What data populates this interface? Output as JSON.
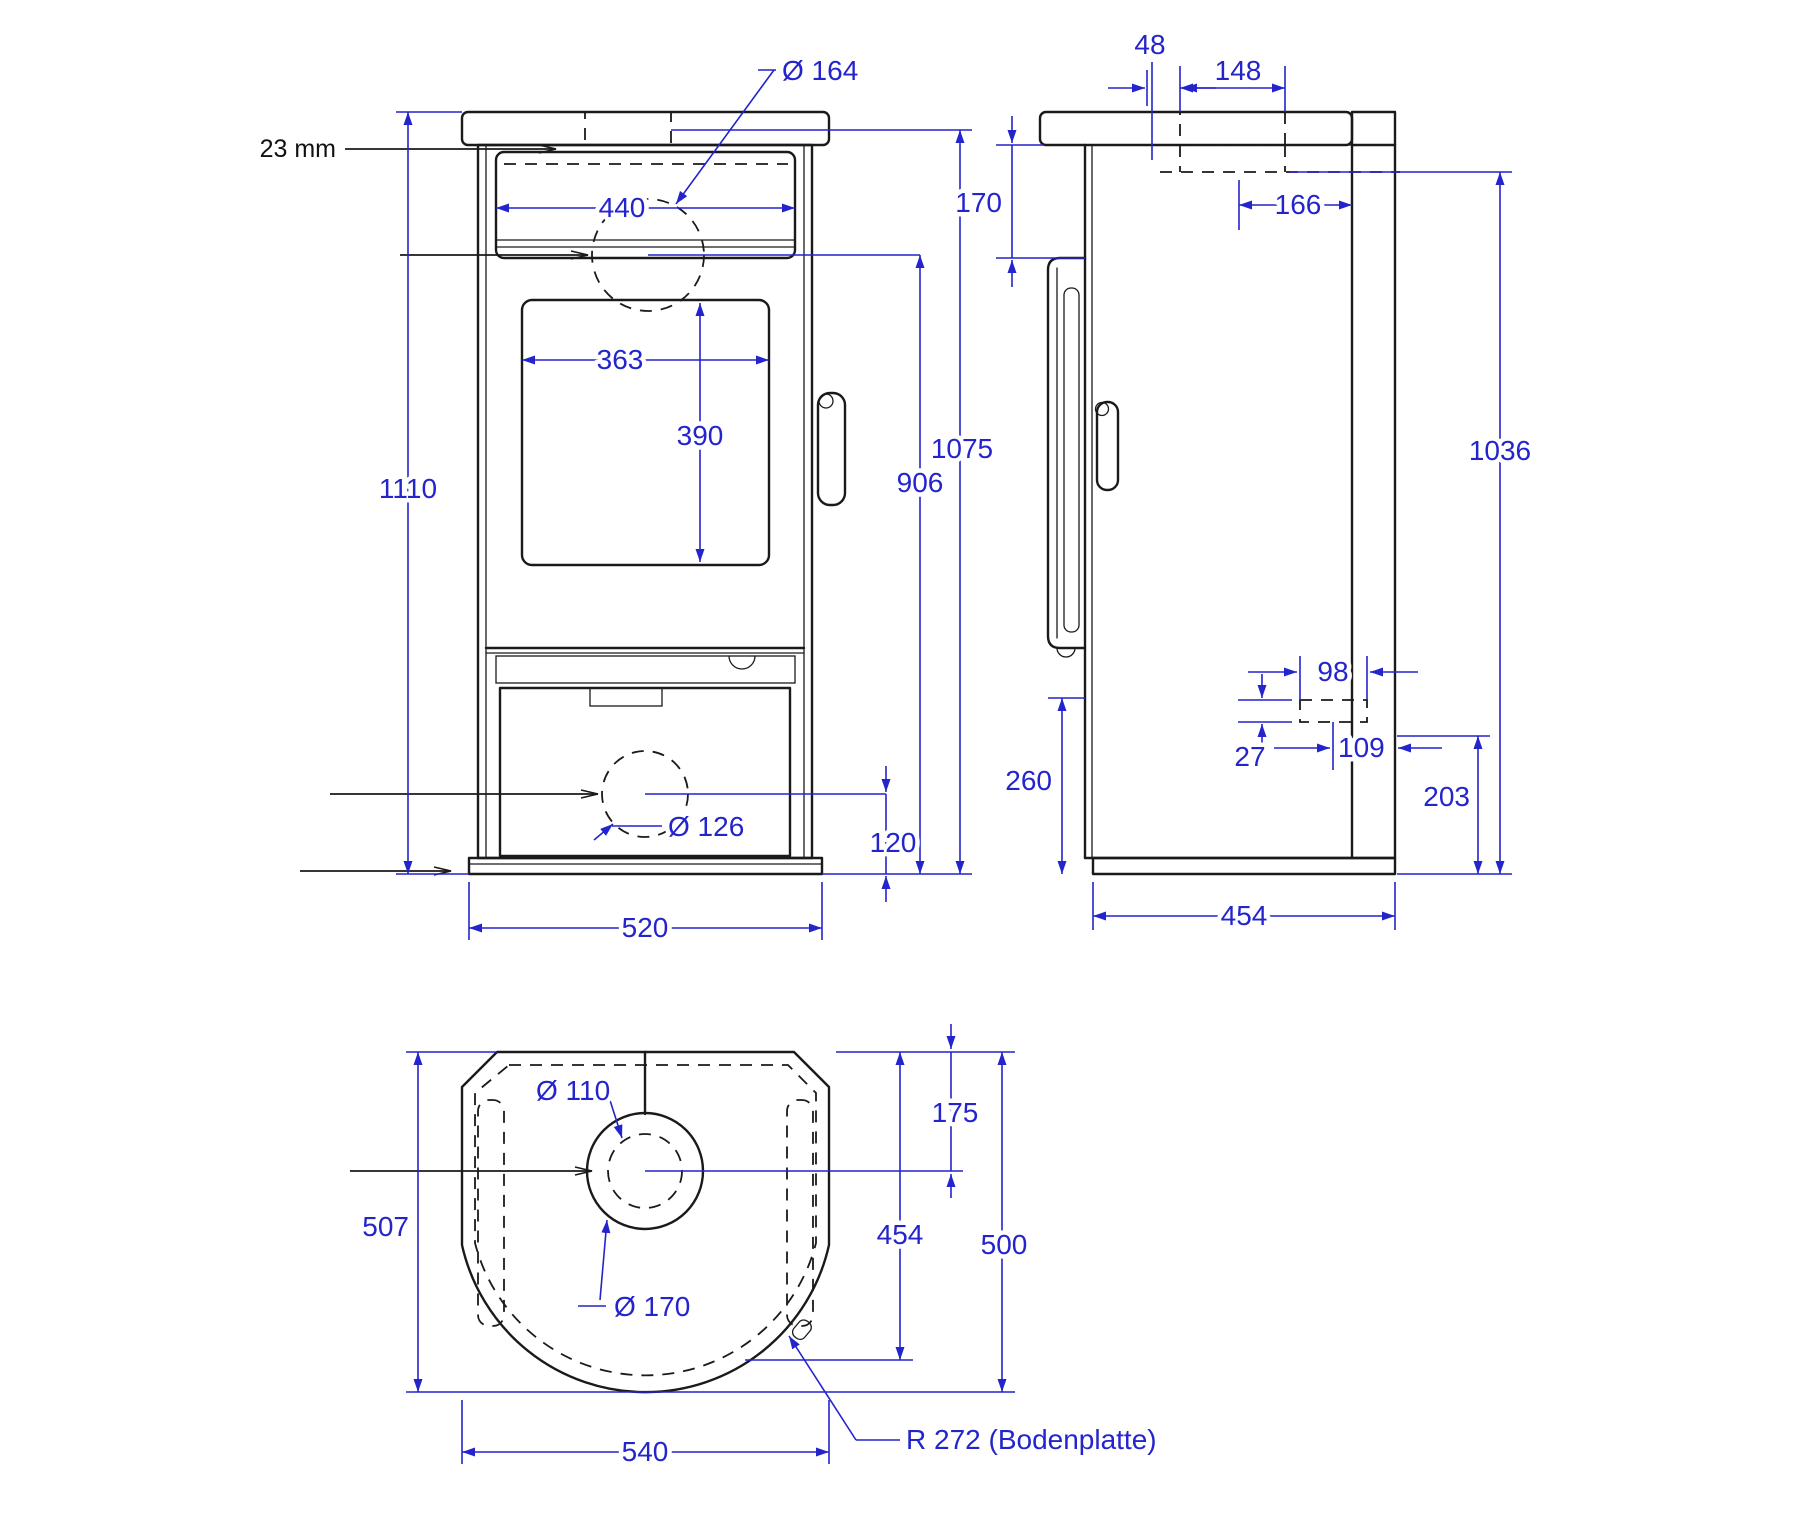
{
  "drawing": {
    "title": "Stove dimensional drawing, three views",
    "units": "mm",
    "colors": {
      "dimension": "#2424cc",
      "geometry": "#1a1a1a",
      "background": "#ffffff"
    },
    "front_view": {
      "dims": {
        "note_23mm": "23 mm",
        "dia_top_outlet": "Ø 164",
        "top_box_width": "440",
        "glass_width": "363",
        "glass_height": "390",
        "total_height": "1110",
        "outlet_center_height": "906",
        "body_height": "1075",
        "dia_air_inlet": "Ø 126",
        "inlet_center_height": "120",
        "base_width": "520"
      }
    },
    "side_view": {
      "dims": {
        "outlet_offset": "48",
        "outlet_length": "148",
        "top_section_height": "170",
        "outlet_to_rear": "166",
        "rear_height": "1036",
        "rear_inlet_width": "98",
        "rear_inlet_height": "27",
        "rear_inlet_offset": "109",
        "lower_section_height": "260",
        "rear_inlet_bottom_height": "203",
        "base_depth": "454"
      }
    },
    "top_view": {
      "dims": {
        "dia_flue_inner": "Ø 110",
        "dia_flue_collar": "Ø 170",
        "flue_center_from_front": "175",
        "front_to_arc": "454",
        "overall_depth_500": "500",
        "overall_depth_507": "507",
        "base_plate_width": "540",
        "base_plate_radius_note": "R 272 (Bodenplatte)"
      }
    }
  }
}
